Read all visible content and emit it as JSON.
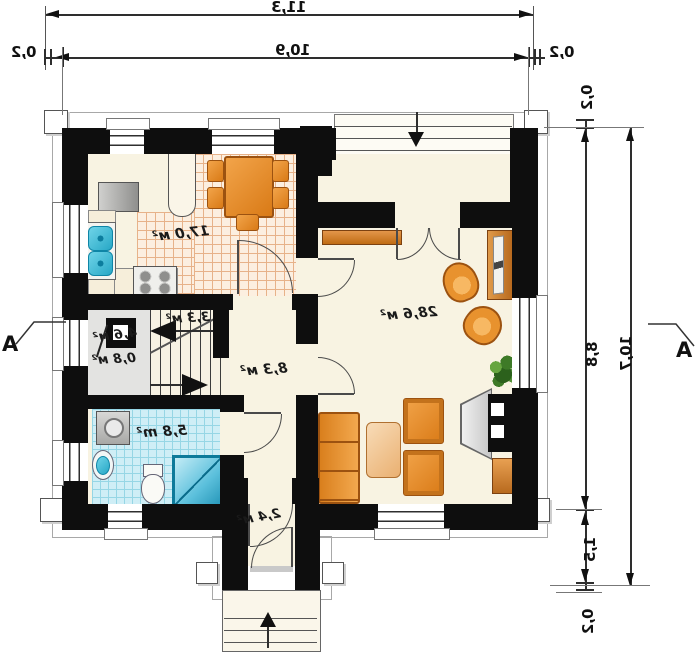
{
  "dimensions": {
    "top_total": "11,3",
    "top_inner": "10,9",
    "top_eave_left": "0,2",
    "top_eave_right": "0,2",
    "side_total": "10,7",
    "side_main": "8,8",
    "side_entry": "1,5",
    "side_eave_top": "0,2",
    "side_eave_bottom": "0,2"
  },
  "section_marker": {
    "label": "A"
  },
  "rooms": {
    "kitchen_dining": {
      "area": "17,0 м²"
    },
    "living": {
      "area": "28,6 м²"
    },
    "hall": {
      "area": "8,3 м²"
    },
    "stair_landing": {
      "area": "3,3 м²"
    },
    "understair_a": {
      "area": "4,6 м²"
    },
    "understair_b": {
      "area": "0,8 м²"
    },
    "bathroom": {
      "area": "5,8 m²"
    },
    "vestibule": {
      "area": "2,4 м²"
    }
  },
  "colors": {
    "wall": "#0e0e0e",
    "floor_cream": "#f8f3e2",
    "kitchen_tile": "#fcefe0",
    "kitchen_tile_line": "#e7b289",
    "bath_tile": "#cfeef6",
    "bath_tile_line": "#96d6e5",
    "stair_gray": "#e3e3e1",
    "furniture_orange": "#e8922e",
    "wood_brown": "#c06c14",
    "fixture_cyan": "#35bcd9",
    "fireplace_gray": "#d9d9d9",
    "plant_green": "#3e7a27",
    "dimension_line": "#2e2e2e"
  }
}
